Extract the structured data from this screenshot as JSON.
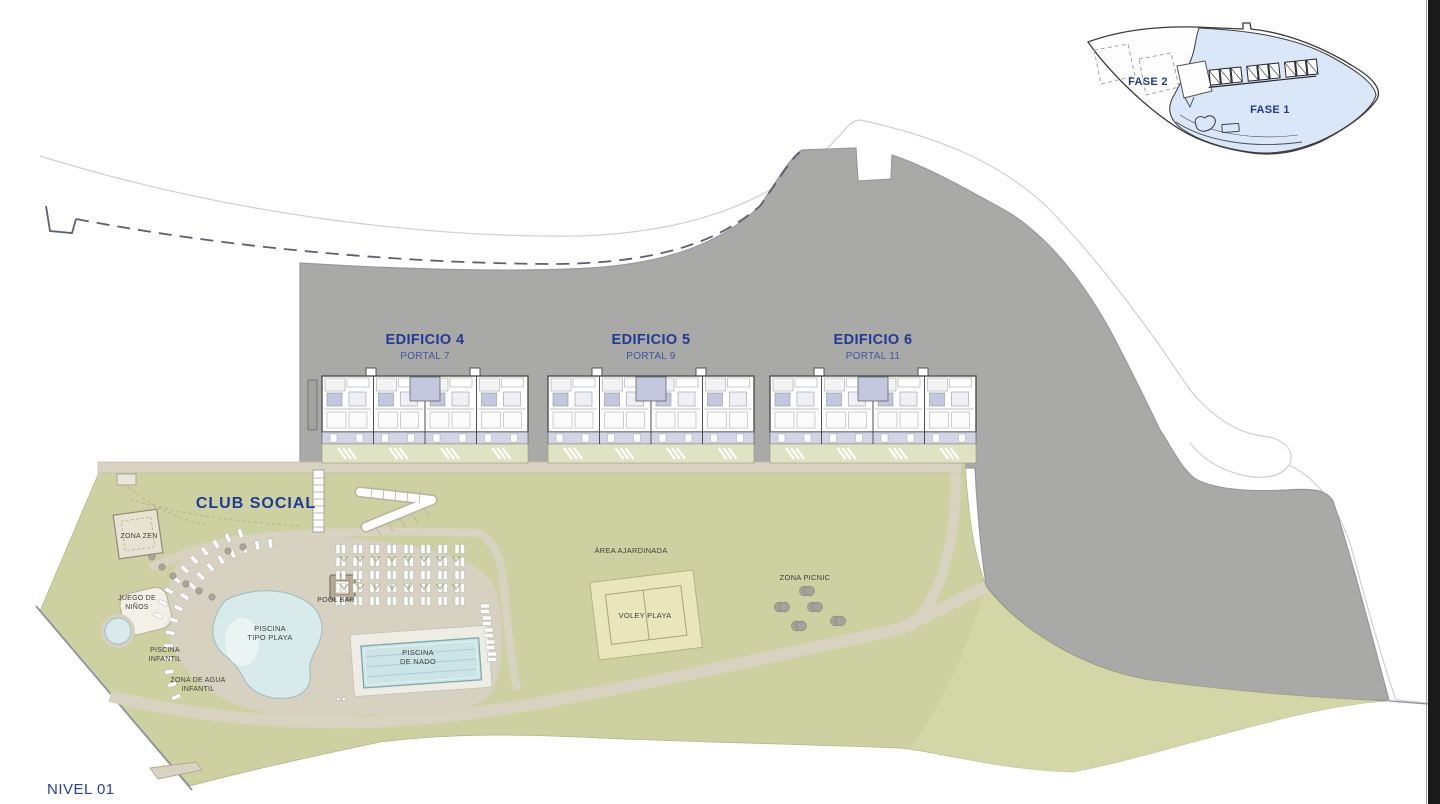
{
  "plan": {
    "level_label": "NIVEL 01",
    "buildings": [
      {
        "name": "EDIFICIO 4",
        "portal": "PORTAL 7"
      },
      {
        "name": "EDIFICIO 5",
        "portal": "PORTAL 9"
      },
      {
        "name": "EDIFICIO 6",
        "portal": "PORTAL 11"
      }
    ],
    "club": {
      "title": "CLUB SOCIAL"
    },
    "amenities": {
      "zona_zen": "ZONA ZEN",
      "juego_ninos_1": "JUEGO DE",
      "juego_ninos_2": "NIÑOS",
      "piscina_infantil_1": "PISCINA",
      "piscina_infantil_2": "INFANTIL",
      "zona_agua_1": "ZONA DE AGUA",
      "zona_agua_2": "INFANTIL",
      "piscina_playa_1": "PISCINA",
      "piscina_playa_2": "TIPO PLAYA",
      "pool_bar": "POOL BAR",
      "piscina_nado_1": "PISCINA",
      "piscina_nado_2": "DE NADO",
      "area_ajardinada": "ÁREA AJARDINADA",
      "voley": "VOLEY PLAYA",
      "picnic": "ZONA PICNIC"
    },
    "inset": {
      "fase1": "FASE 1",
      "fase2": "FASE 2"
    },
    "colors": {
      "label_blue": "#223a94",
      "portal_blue": "#44569f",
      "site_gray": "#a9a9a7",
      "green": "#cdd1a2",
      "green_light": "#dfe2c3",
      "path_beige": "#d8d2c0",
      "pool_blue": "#d8ebea",
      "terrace_lavender": "#d3d5e6",
      "fase1_fill": "#d9e7f8",
      "text_dark": "#3f3f38"
    }
  }
}
